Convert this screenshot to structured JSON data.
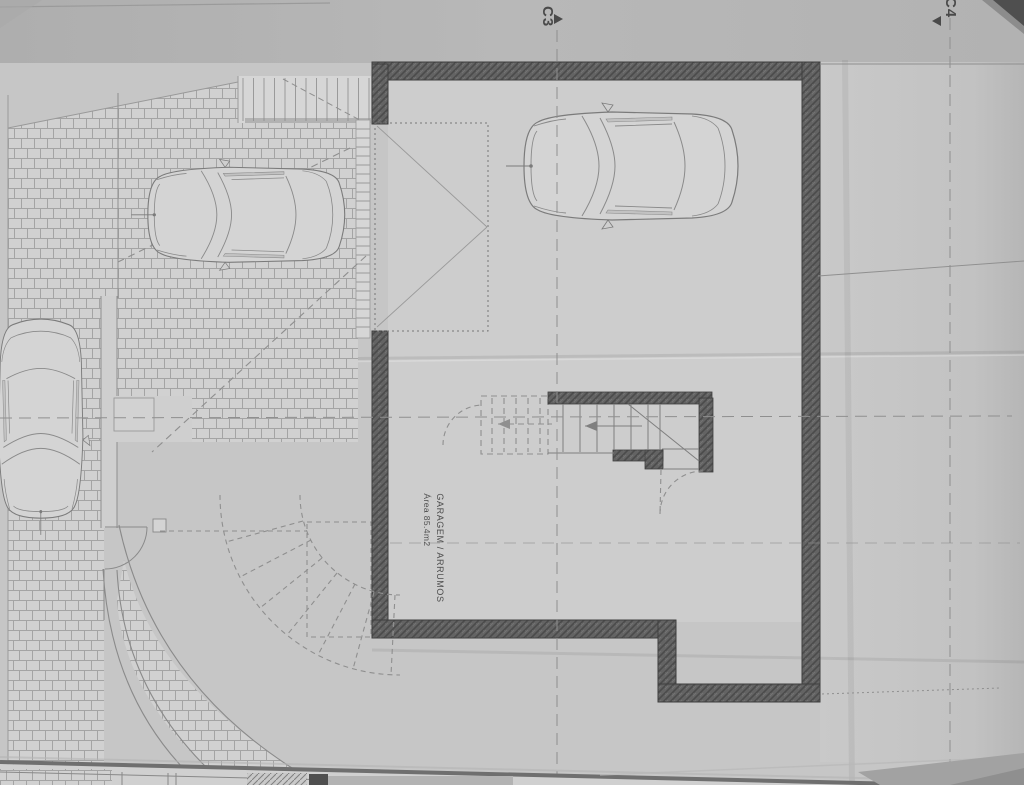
{
  "drawing": {
    "grid_markers": [
      {
        "id": "c3",
        "label": "C3"
      },
      {
        "id": "c4",
        "label": "C4"
      }
    ],
    "room_label": {
      "name": "GARAGEM / ARRUMOS",
      "area": "Área 85.4m2"
    },
    "colors": {
      "paper": "#c6c6c6",
      "paper_light": "#cdcdcd",
      "paper_top_band": "#b4b4b4",
      "wall_fill": "#5e5e5e",
      "thin_line": "#8a8a8a",
      "brick_joint": "#a4a4a4",
      "text": "#4a4a4a",
      "corner_shadow": "#4f4f4f"
    }
  }
}
